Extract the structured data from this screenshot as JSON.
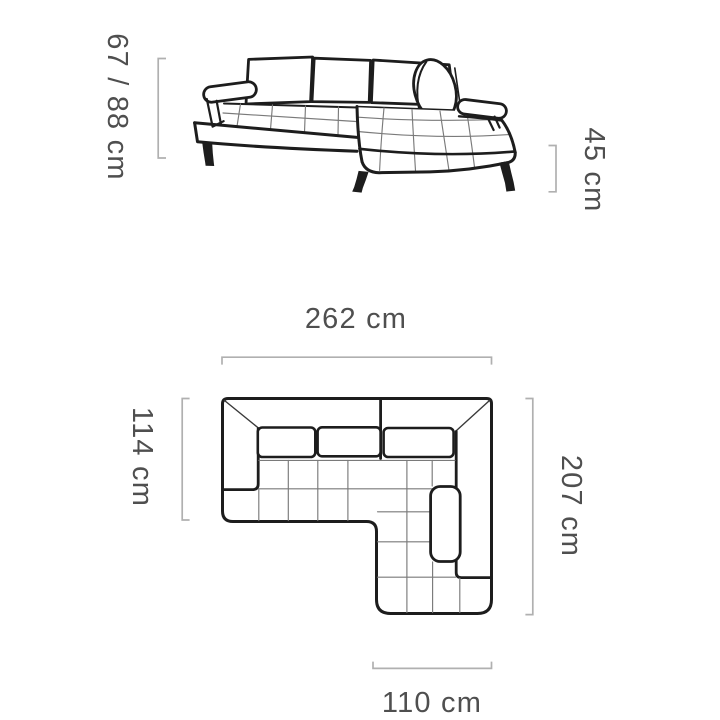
{
  "side_view": {
    "height_label": "67 / 88 cm",
    "seat_height_label": "45 cm"
  },
  "top_view": {
    "width_label": "262 cm",
    "depth_left_label": "114 cm",
    "depth_right_label": "207 cm",
    "chaise_width_label": "110 cm"
  },
  "colors": {
    "outline": "#1d1d1d",
    "seam": "#7a7a7a",
    "dimension_line": "#b0b0b0",
    "dimension_text": "#4f4f4f",
    "background": "#ffffff"
  }
}
